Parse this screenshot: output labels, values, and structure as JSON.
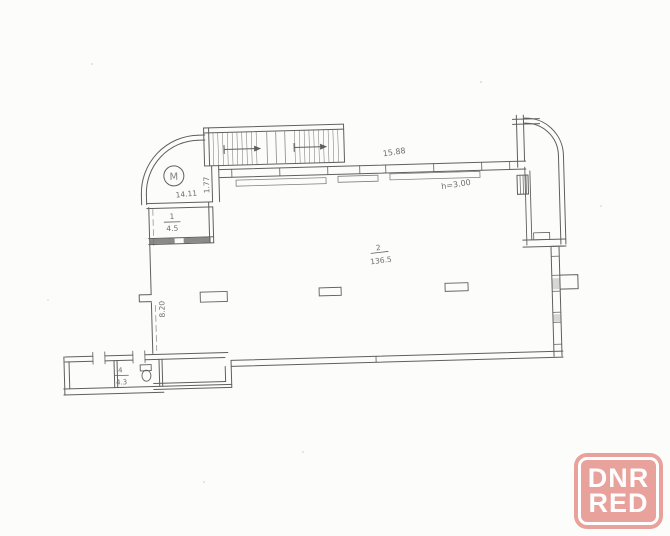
{
  "watermark": {
    "line1": "DNR",
    "line2": "RED",
    "color": "#e79b94"
  },
  "plan": {
    "ink_color": "#4a4a4a",
    "dimensions": {
      "top_width": "15.88",
      "stair_wall": "1.77",
      "vestibule_width": "14.11",
      "left_wall_height": "8.20",
      "ceiling_height": "h=3.00"
    },
    "marks": {
      "circled_letter": "M"
    },
    "rooms": {
      "vestibule": {
        "number": "1",
        "area": "4.5"
      },
      "main_hall": {
        "number": "2",
        "area": "136.5"
      },
      "wc": {
        "number": "4",
        "area": "4.3"
      }
    }
  }
}
